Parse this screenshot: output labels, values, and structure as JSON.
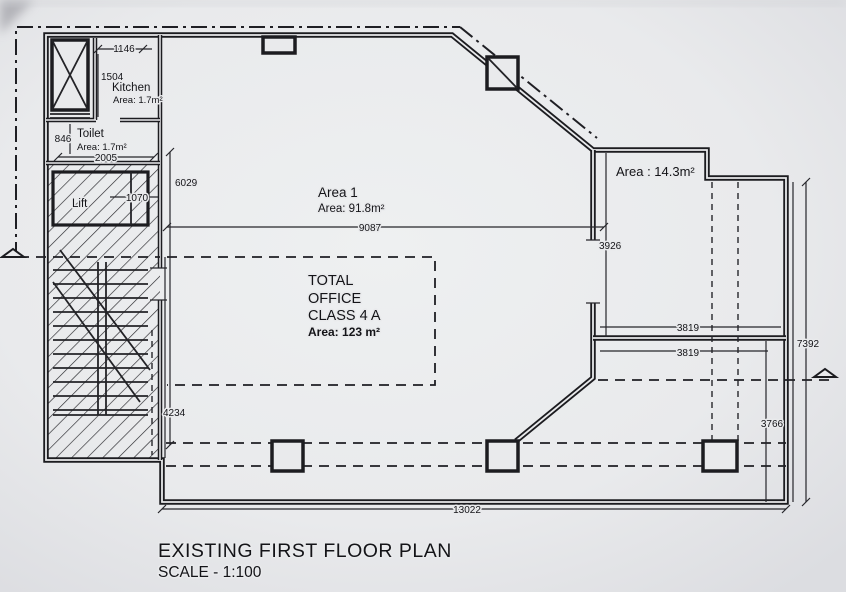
{
  "drawing": {
    "title": "EXISTING FIRST FLOOR PLAN",
    "scale_label": "SCALE - 1:100",
    "rooms": {
      "kitchen": {
        "name": "Kitchen",
        "area": "Area: 1.7m²"
      },
      "toilet": {
        "name": "Toilet",
        "area": "Area: 1.7m²"
      },
      "lift": {
        "name": "Lift"
      },
      "area1": {
        "name": "Area 1",
        "area": "Area: 91.8m²"
      },
      "area2": {
        "label": "Area : 14.3m²"
      },
      "office": {
        "line1": "TOTAL",
        "line2": "OFFICE",
        "line3": "CLASS 4 A",
        "area": "Area: 123 m²"
      }
    },
    "dimensions": {
      "d1146": "1146",
      "d1504": "1504",
      "d846": "846",
      "d2005": "2005",
      "d1070": "1070",
      "d6029": "6029",
      "d9087": "9087",
      "d3926": "3926",
      "d3819a": "3819",
      "d3819b": "3819",
      "d7392": "7392",
      "d3766": "3766",
      "d4234": "4234",
      "d13022": "13022"
    }
  }
}
